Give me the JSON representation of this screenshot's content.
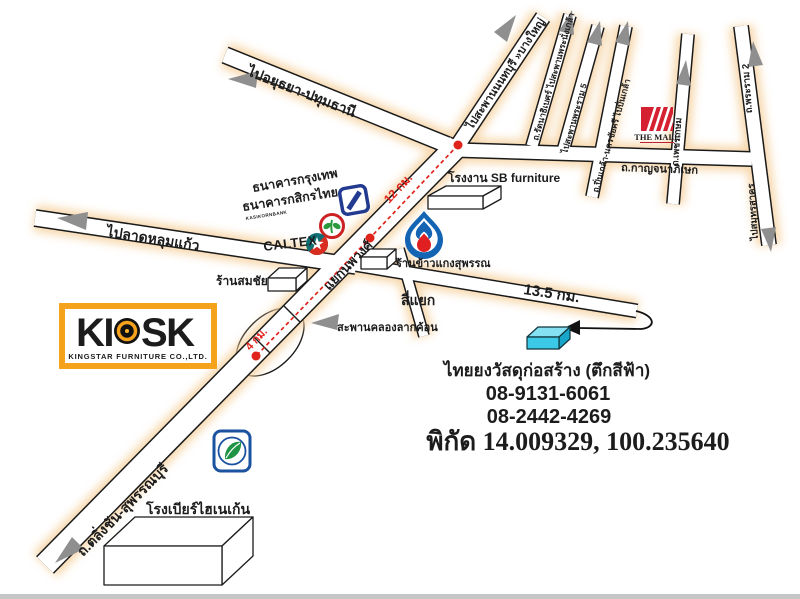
{
  "roads": {
    "to_ayutthaya": "ไปอยุธยา-ปทุมธานี",
    "to_nonthaburi": "ไปสะพานนนทบุรี »บางใหญ่",
    "ratanathibet": "ถ.รัตนาธิเบศร์ ไปสะพานพระนั่งเกล้า",
    "rama5": "ไปสะพานพระราม 5",
    "pinklao": "ถ.ปิ่นเกล้า-นครชัยศรี ไปปิ่นเกล้า",
    "phetkasem": "ถ.เพชรเกษม",
    "kanchanaphisek": "ถ.กาญจนาภิเษก",
    "rama2": "ถ.พระราม 2",
    "to_samutsakhon": "ไปสมุทรสาคร",
    "to_latlumkaeo": "ไปลาดหลุมแก้ว",
    "talingchan": "ถ.ตลิ่งชัน-สุพรรณบุรี",
    "nopphawong_junction": "แยกนพวงศ์",
    "si_yaek": "สี่แยก",
    "bridge": "สะพานคลองลากค้อน"
  },
  "route": {
    "d12": "12 กม.",
    "d4": "4 กม.",
    "d135": "13.5 กม."
  },
  "places": {
    "bangkok_bank": "ธนาคารกรุงเทพ",
    "kasikorn_bank": "ธนาคารกสิกรไทย",
    "kasikorn_sub": "KASIKORNBANK",
    "caltex": "CALTEX",
    "somchai_shop": "ร้านสมชัย",
    "sb_factory": "โรงงาน SB furniture",
    "rice_shop": "ร้านข้าวแกงสุพรรณ",
    "the_mall": "THE MALL",
    "heineken_brewery": "โรงเบียร์ไฮเนเก้น"
  },
  "kiosk": {
    "name": "KIOSK",
    "left": "KI",
    "right": "SK",
    "subtitle": "KINGSTAR FURNITURE CO.,LTD."
  },
  "destination": {
    "name": "ไทยยงวัสดุก่อสร้าง (ตึกสีฟ้า)",
    "phone1": "08-9131-6061",
    "phone2": "08-2442-4269",
    "coordinates": "พิกัด 14.009329, 100.235640"
  },
  "colors": {
    "route_red": "#e0241c",
    "coords_red": "#cc1111",
    "kiosk_orange": "#f5a21d",
    "mall_red": "#d42030",
    "caltex_teal": "#0c5f68",
    "bangkok_bank_blue": "#1b3990",
    "kasikorn_red": "#cf3a2a",
    "ptt_blue": "#1464b4",
    "bangchak_blue": "#1b52a0",
    "cyan_building": "#3cc9e8",
    "road_glow": "#f6d2a0"
  }
}
